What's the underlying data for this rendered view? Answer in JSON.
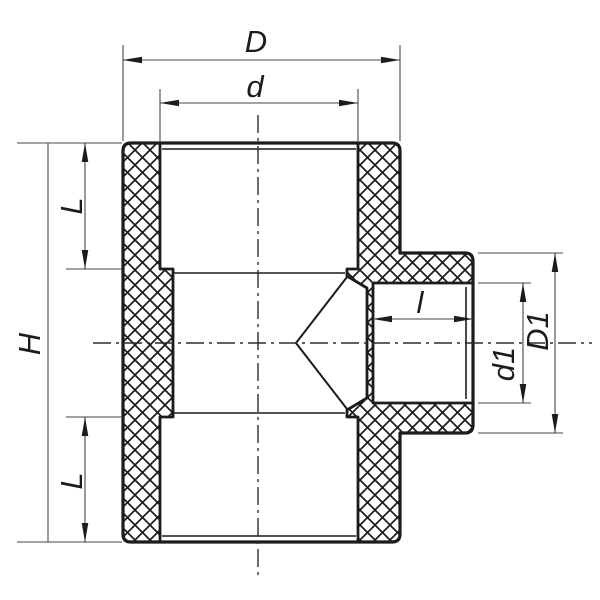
{
  "drawing": {
    "description": "Cross-section technical drawing of a reducing tee pipe fitting with crosshatched walls and dimension callouts",
    "colors": {
      "outline": "#1c1c1c",
      "dimension_line": "#474747",
      "background": "#ffffff"
    },
    "dimensions": {
      "overall_width": "D",
      "main_socket_diameter": "d",
      "top_socket_depth": "L",
      "overall_height": "H",
      "bottom_socket_depth": "L",
      "branch_socket_length": "l",
      "branch_socket_diameter": "d1",
      "branch_outer_diameter": "D1"
    }
  }
}
